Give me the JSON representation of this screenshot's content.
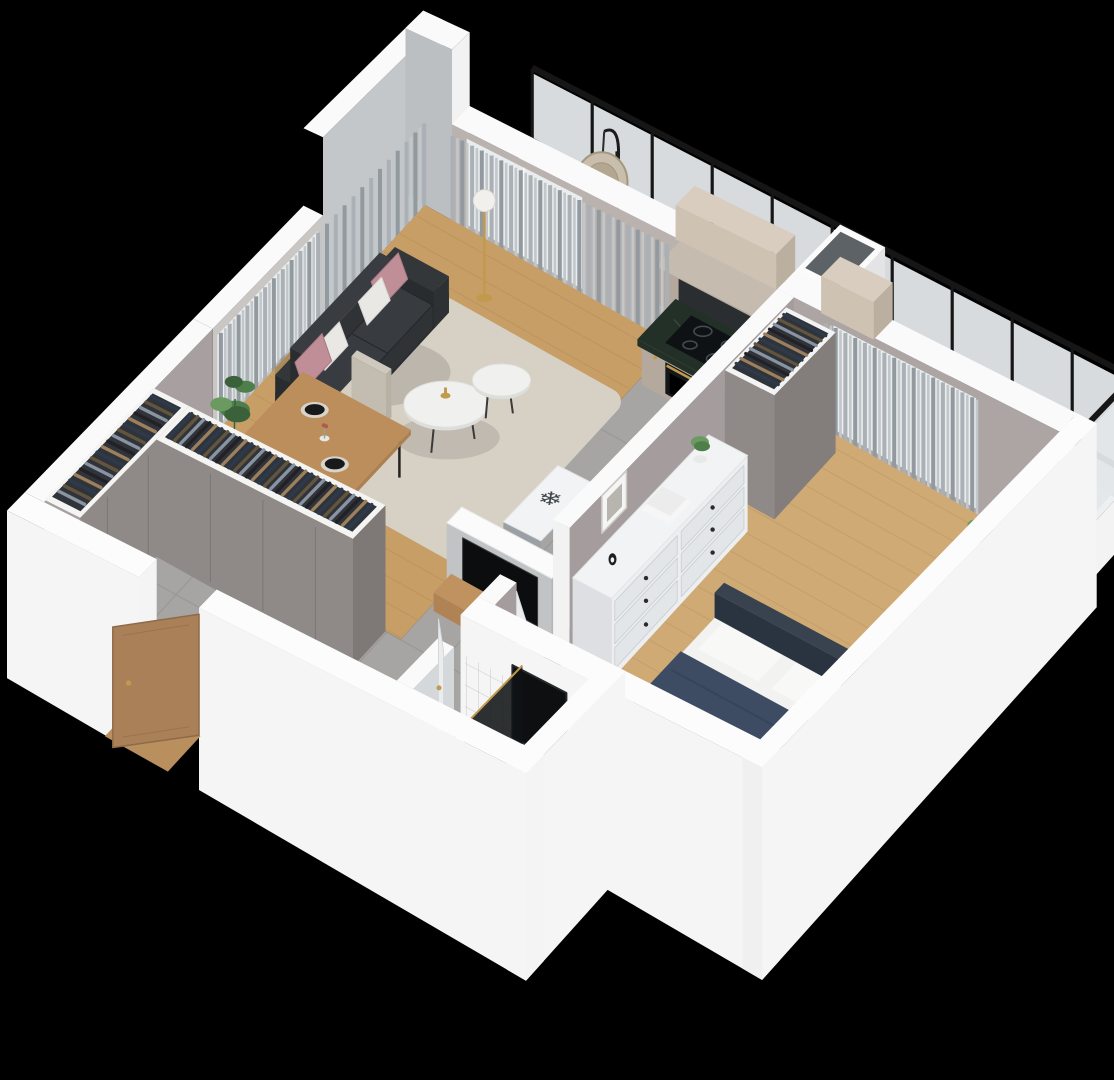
{
  "scene": {
    "background": "#000000",
    "view_label": "apartment-3d-floorplan-render"
  },
  "icons": {
    "freezer": "❄"
  },
  "colors": {
    "wallTop": "#fafafa",
    "wallFaceSE": "#f5f5f6",
    "wallFaceSW": "#e8e9ea",
    "wallInterior": "#a8a0a0",
    "wallInteriorDark": "#98918f",
    "tallWallGray": "#c4c7ca",
    "woodLiving": "#c79e66",
    "woodPlankLine": "#a87f4e",
    "woodBedroom": "#cfaa74",
    "tileFloor": "#a6a5a3",
    "tileLine": "#8f8e8c",
    "bathFloor": "#c9cdcf",
    "bathMarble": "#d9dcdd",
    "rug": "#d8d2c8",
    "sofaDark": "#292c2f",
    "sofaMid": "#2f3336",
    "sofaLight": "#383c40",
    "pillowPink": "#c08e97",
    "pillowWhite": "#eae8e4",
    "curtain1": "#aab0b5",
    "curtain2": "#c2c7ca",
    "curtain3": "#929aa0",
    "glassWindow": "#e9edee",
    "railingBlack": "#161617",
    "railingGlass": "#e3e7e9",
    "balconyFloor": "#edeff0",
    "cabinetBeige": "#b4a99c",
    "cabinetBeigeDark": "#a2978a",
    "cabinetTan": "#cec2b2",
    "cabinetTanDark": "#bbaf9f",
    "counterDark": "#233028",
    "counterVein": "#4f6150",
    "applianceBlack": "#111416",
    "backsplash": "#2b2e30",
    "gold": "#c29a4d",
    "fridgeGray": "#9aa0a4",
    "fridgeTop": "#f2f3f4",
    "dresserWhite": "#eceef0",
    "dresserFace": "#e3e6e8",
    "knobDark": "#2b2b2b",
    "bedNavy": "#3d4c62",
    "bedNavyDark": "#34425a",
    "bedWhite": "#f2f2f1",
    "headboard": "#303947",
    "doorWood": "#aa8058",
    "doorWoodDark": "#8f6a47",
    "doorWhite": "#eaeced",
    "wardrobeTaupe": "#8f8a87",
    "wardrobeDark": "#7e7976",
    "shaftHole": "#5d6266",
    "plantGreen": "#4e7f4b",
    "plantGreenDark": "#3a6139",
    "plantGreenLight": "#6b9a60",
    "potWhite": "#e9e9e7",
    "tvBlack": "#0b0d0e",
    "mirrorBlack": "#0d0f10",
    "chairRattan": "#c9bdac",
    "chairRattanDark": "#a4977f",
    "benchWood": "#c98a4a",
    "clothes": [
      "#2e3a4a",
      "#63543e",
      "#8a93a0",
      "#232126",
      "#9c7f5c"
    ]
  }
}
